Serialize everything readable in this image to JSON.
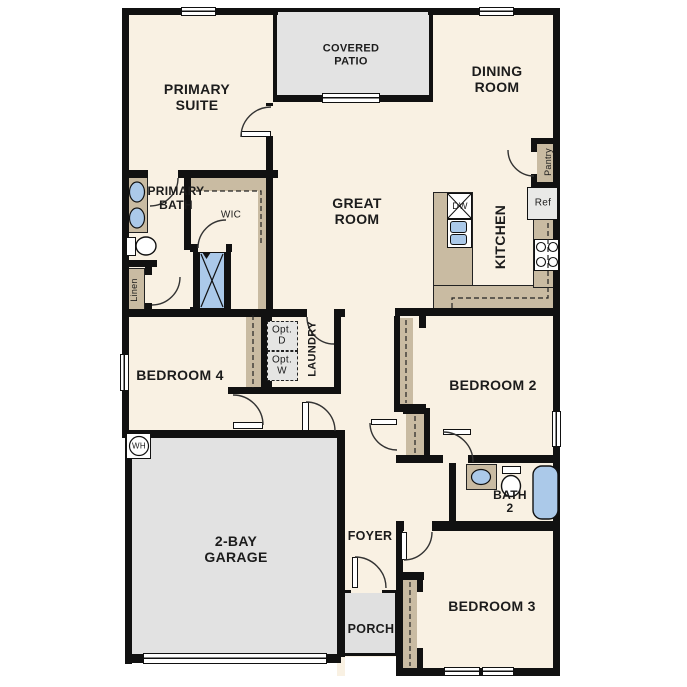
{
  "plan_type": "single-story floor plan",
  "labels": {
    "primary_suite": "PRIMARY\nSUITE",
    "covered_patio": "COVERED\nPATIO",
    "dining_room": "DINING\nROOM",
    "great_room": "GREAT\nROOM",
    "kitchen": "KITCHEN",
    "pantry": "Pantry",
    "ref": "Ref",
    "dw": "DW",
    "wic": "WIC",
    "primary_bath": "PRIMARY\nBATH",
    "linen": "Linen",
    "opt_d": "Opt.\nD",
    "opt_w": "Opt.\nW",
    "laundry": "LAUNDRY",
    "bedroom4": "BEDROOM 4",
    "bedroom2": "BEDROOM 2",
    "bath2": "BATH\n2",
    "wh": "WH",
    "garage": "2-BAY\nGARAGE",
    "foyer": "FOYER",
    "porch": "PORCH",
    "bedroom3": "BEDROOM 3"
  },
  "colors": {
    "wall": "#111111",
    "floor": "#f9f1e3",
    "concrete_gray": "#e2e2e2",
    "casework_tan": "#c9bba2",
    "fixture_blue": "#abc9e9",
    "appliance_gray": "#e9e9e7",
    "text": "#1c1c1c"
  }
}
